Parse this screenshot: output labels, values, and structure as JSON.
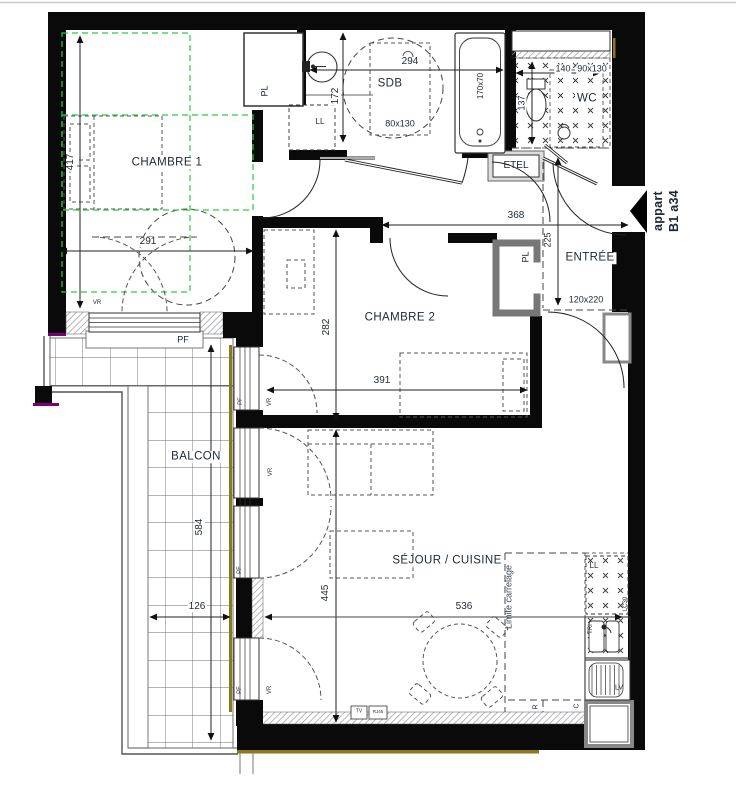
{
  "meta": {
    "drawing_type": "apartment floor plan",
    "apartment": {
      "line1": "appart",
      "line2": "B1 a34"
    }
  },
  "rooms": {
    "chambre1": "CHAMBRE 1",
    "sdb": "SDB",
    "wc": "WC",
    "entree": "ENTRÉE",
    "chambre2": "CHAMBRE 2",
    "balcon": "BALCON",
    "sejour": "SÉJOUR / CUISINE"
  },
  "dims": {
    "c1_h": "417",
    "c1_w": "291",
    "sdb_w": "294",
    "sdb_h": "172",
    "sdb_shower": "80x130",
    "bath": "170x70",
    "wc_h": "137",
    "wc_w": "140",
    "wc_shower": "90x130",
    "ent_w": "368",
    "ent_h": "225",
    "ent_pass": "120x220",
    "c2_h": "282",
    "c2_w": "391",
    "balc_h": "584",
    "balc_w": "126",
    "sej_h": "445",
    "sej_w": "536"
  },
  "labels": {
    "closet": "PL",
    "washer": "LL",
    "elec": "ETEL",
    "shutter": "VR",
    "window": "PF",
    "tv": "TV",
    "rj45": "RJ45",
    "tile_limit": "Limite carrelage",
    "lc30": "LC30",
    "tri": "TRI",
    "dishwasher": "LV",
    "c": "C",
    "r": "R"
  },
  "colors": {
    "wall": "#0a0a0a",
    "zone_green": "#2ecc40",
    "accent_purple": "#7a007a",
    "accent_olive": "#8a7a1e",
    "text": "#1d2733"
  }
}
